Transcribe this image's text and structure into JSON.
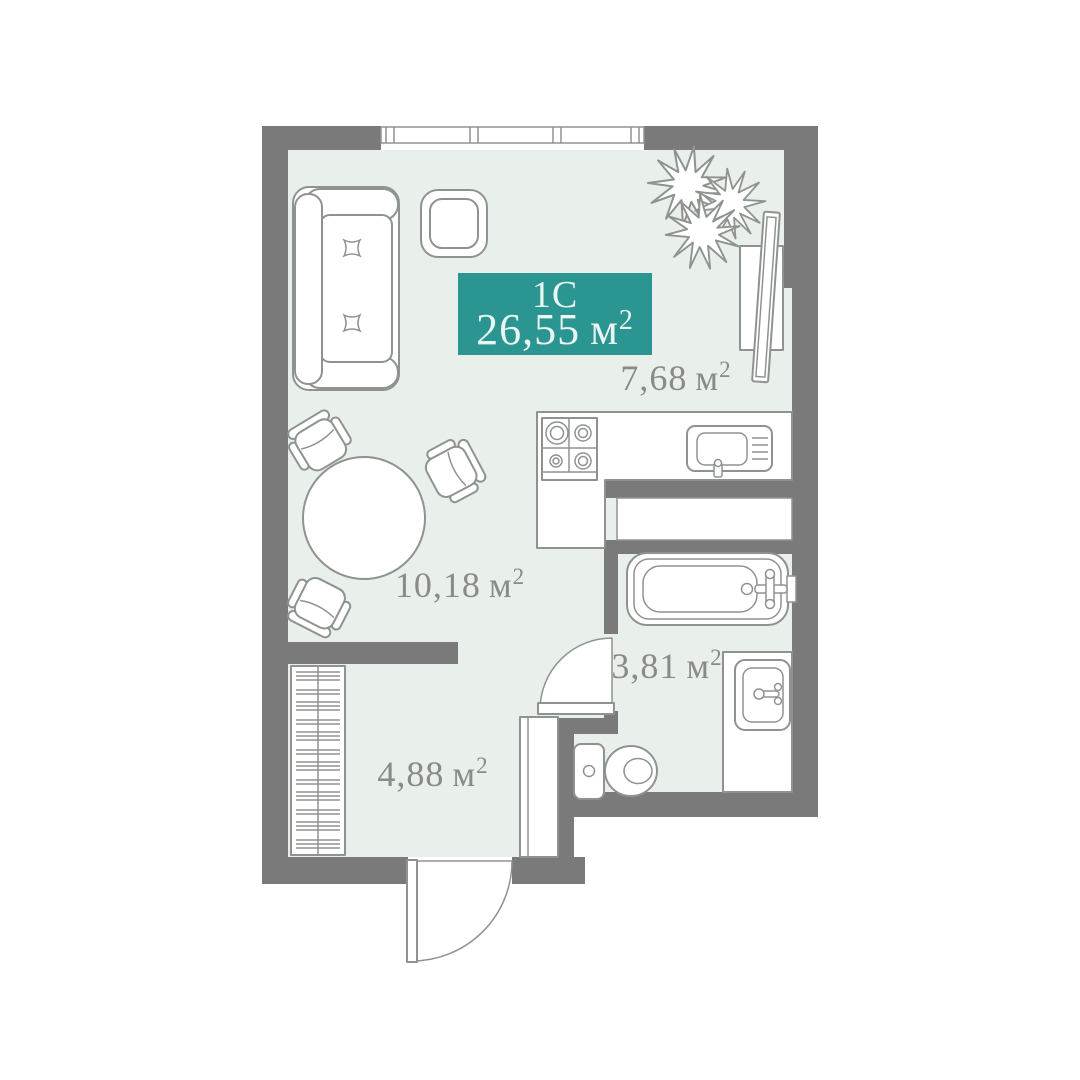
{
  "unit_badge": {
    "type_label": "1С",
    "total_area": "26,55",
    "area_unit": "м",
    "area_superscript": "2",
    "background_color": "#2b9591"
  },
  "room_labels": [
    {
      "id": "kitchen-living-room",
      "area": "7,68"
    },
    {
      "id": "living-area",
      "area": "10,18"
    },
    {
      "id": "bathroom",
      "area": "3,81"
    },
    {
      "id": "hallway",
      "area": "4,88"
    }
  ],
  "colors": {
    "wall": "#7a7a7a",
    "floor": "#e9f0ec",
    "furniture_outline": "#8f938f",
    "label_text": "#8a8a8a",
    "badge_background": "#2b9591",
    "badge_text": "#eaf5f2",
    "page_background": "#ffffff"
  },
  "icons": [
    "sofa",
    "side-table",
    "dining-table",
    "chair",
    "wardrobe-closet",
    "kitchen-counter",
    "stove",
    "kitchen-sink",
    "ventilation-duct",
    "tv-unit",
    "monstera-plant",
    "window",
    "bathtub",
    "vanity",
    "washbasin",
    "toilet",
    "bathroom-door",
    "entrance-door"
  ]
}
